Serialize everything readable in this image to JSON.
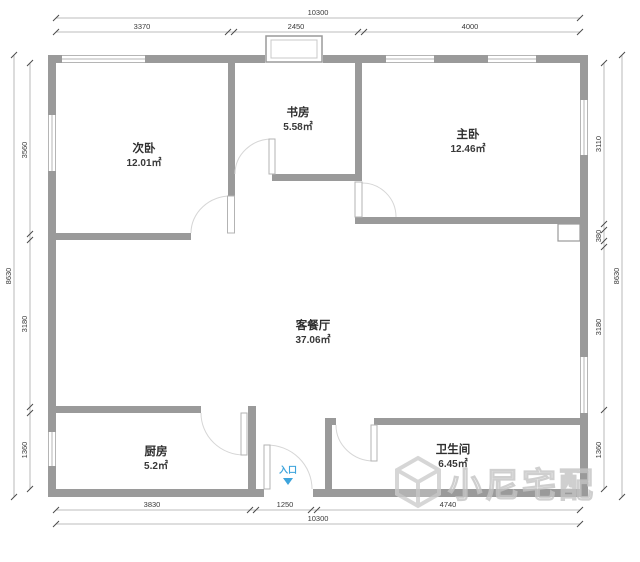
{
  "plan": {
    "rooms": [
      {
        "name": "次卧",
        "area": "12.01㎡"
      },
      {
        "name": "书房",
        "area": "5.58㎡"
      },
      {
        "name": "主卧",
        "area": "12.46㎡"
      },
      {
        "name": "客餐厅",
        "area": "37.06㎡"
      },
      {
        "name": "厨房",
        "area": "5.2㎡"
      },
      {
        "name": "卫生间",
        "area": "6.45㎡"
      }
    ],
    "entry": {
      "label": "入口"
    },
    "watermark": {
      "text": "小尼宅配"
    },
    "dims": {
      "top_total": "10300",
      "bottom_total": "10300",
      "left_total": "8630",
      "right_total": "8630",
      "top_segments": [
        "3370",
        "2450",
        "4000"
      ],
      "bottom_segments": [
        "3830",
        "1250",
        "4740"
      ],
      "left_segments": [
        "3560",
        "3180",
        "1360"
      ],
      "right_segments": [
        "3110",
        "380",
        "3180",
        "1360"
      ]
    },
    "colors": {
      "wall": "#9a9a9a",
      "dim_line": "#a9a9a9",
      "dim_text": "#3a3a3a",
      "entry_blue": "#3da4dc",
      "watermark_gray": "#c4c4c4"
    }
  }
}
